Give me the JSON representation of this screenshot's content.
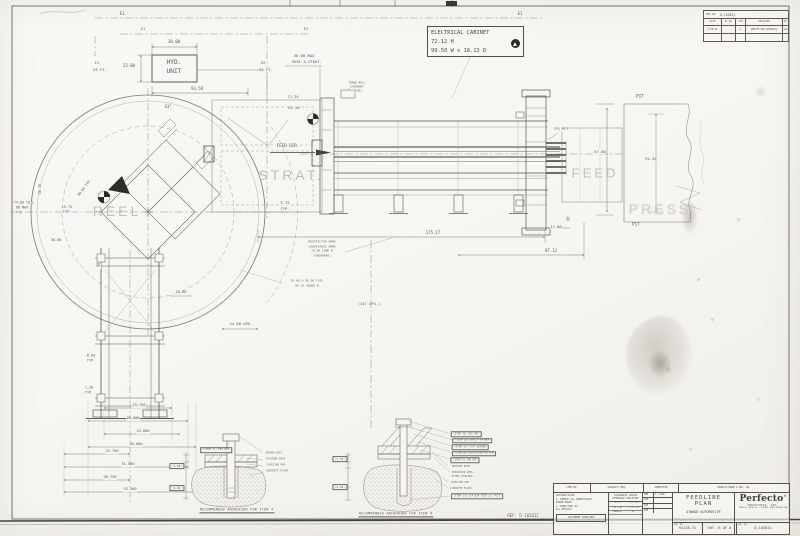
{
  "colors": {
    "line": "#5d5a53",
    "paper": "#f7f6f2",
    "ghost_text": "#bfbdb6"
  },
  "electrical_cabinet": {
    "line1": "ELECTRICAL CABINET",
    "line2": "72.12 H",
    "line3": "99.50 W x 18.13 D"
  },
  "revision_block": {
    "dwg_label": "DWG NO.",
    "dwg_no": "D-103021",
    "headers": [
      "DATE",
      "EC NO",
      "SYM",
      "REVISION",
      "BY"
    ],
    "rows": [
      [
        "2-28-92",
        "",
        "A",
        "UPDATE PER APPROVAL",
        "JAS"
      ]
    ]
  },
  "title_block": {
    "parts_header": [
      "ITEM NO.",
      "QUANTITY REQ.",
      "SUBMITTED",
      "MANUFACTURER & MDL. NO."
    ],
    "notes_title": "MACHINE NOTES",
    "notes": [
      "1. REMOVE ALL UNNECESSARY",
      "   SHARP EDGES",
      "2. MARK PART NO.",
      "   ALL DETAILS"
    ],
    "customer_supplied": "CUSTOMER SUPPLIED",
    "tol_title1": "TOLERANCES UNLESS",
    "tol_title2": "OTHERWISE SPECIFIED",
    "tol_rows": [
      [
        ".X ±.1",
        "1 PL ±.5"
      ],
      [
        ".XX ±.01",
        "2 PL ±.13"
      ],
      [
        "ANGLES",
        "±1°"
      ]
    ],
    "appr_rows": [
      [
        "DRN",
        "P. LACE"
      ],
      [
        "CHK",
        ""
      ],
      [
        "APP",
        ""
      ],
      [
        "APP",
        ""
      ]
    ],
    "title_line1": "FEEDLINE",
    "title_line2": "PLAN",
    "customer": "ATWOOD AUTOMOTIVE",
    "ord_label": "ORD. NO.",
    "ord_no": "92128-31",
    "sheet": "SHT. 8 OF 8",
    "dwg_label": "DWG. NO.",
    "dwg_no": "D-103021",
    "brand": "Perfecto",
    "brand_reg": "®",
    "brand_line2": "INDUSTRIES, INC.",
    "brand_line3": "1999 W. HIGH ST., PIQUA, OHIO 45356 USA"
  },
  "annotations": [
    {
      "t": "REEL",
      "x": 117,
      "y": 211,
      "s": 14,
      "c": "ghost"
    },
    {
      "t": "STRAT.",
      "x": 291,
      "y": 175,
      "s": 14,
      "c": "ghost"
    },
    {
      "t": "FEED",
      "x": 595,
      "y": 173,
      "s": 13,
      "c": "ghost"
    },
    {
      "t": "PRESS",
      "x": 660,
      "y": 209,
      "s": 14,
      "c": "ghostb"
    },
    {
      "t": "E1",
      "x": 122,
      "y": 14,
      "s": 4
    },
    {
      "t": "E1",
      "x": 520,
      "y": 14,
      "s": 4
    },
    {
      "t": "E1",
      "x": 143,
      "y": 30,
      "s": 3.6
    },
    {
      "t": "E1",
      "x": 306,
      "y": 30,
      "s": 3.6
    },
    {
      "t": "E1",
      "x": 97,
      "y": 63,
      "s": 3.8
    },
    {
      "t": "55 FT.",
      "x": 100,
      "y": 70,
      "s": 3.8
    },
    {
      "t": "E2",
      "x": 263,
      "y": 63,
      "s": 3.8
    },
    {
      "t": "55 FT.",
      "x": 266,
      "y": 70,
      "s": 3.8
    },
    {
      "t": "38.00",
      "x": 174,
      "y": 42,
      "s": 4
    },
    {
      "t": "22.00",
      "x": 129,
      "y": 66,
      "s": 4
    },
    {
      "t": "HYD.",
      "x": 174,
      "y": 63,
      "s": 6.2
    },
    {
      "t": "UNIT",
      "x": 174,
      "y": 72,
      "s": 6.2
    },
    {
      "t": "93.50",
      "x": 197,
      "y": 89,
      "s": 4
    },
    {
      "t": "43°",
      "x": 168,
      "y": 107,
      "s": 4
    },
    {
      "t": "72.24",
      "x": 293,
      "y": 97,
      "s": 3.8
    },
    {
      "t": "65.26",
      "x": 294,
      "y": 108,
      "s": 3.8
    },
    {
      "t": "36.00 MAX",
      "x": 304,
      "y": 56,
      "s": 3.8
    },
    {
      "t": "REEL & STRAT.",
      "x": 307,
      "y": 62,
      "s": 3.8
    },
    {
      "t": "THREE ROLL",
      "x": 357,
      "y": 83,
      "s": 2.8,
      "c": "tiny"
    },
    {
      "t": "CATENARY",
      "x": 357,
      "y": 87,
      "s": 2.8,
      "c": "tiny"
    },
    {
      "t": "(STEEL)",
      "x": 357,
      "y": 91,
      "s": 2.8,
      "c": "tiny"
    },
    {
      "t": "FEED DIR.",
      "x": 288,
      "y": 146,
      "s": 4.2
    },
    {
      "t": "5.75",
      "x": 285,
      "y": 203,
      "s": 3.8
    },
    {
      "t": "TYP.",
      "x": 285,
      "y": 209,
      "s": 3.8
    },
    {
      "t": "74.00 COIL",
      "x": 24,
      "y": 203,
      "s": 3.4
    },
    {
      "t": "OD MAX",
      "x": 22,
      "y": 208,
      "s": 3.4
    },
    {
      "t": "TYP.",
      "x": 20,
      "y": 213,
      "s": 3.4
    },
    {
      "t": "36.50",
      "x": 41,
      "y": 189,
      "s": 3.6,
      "r": -90
    },
    {
      "t": "15.75",
      "x": 67,
      "y": 208,
      "s": 3.6
    },
    {
      "t": "TYP.",
      "x": 67,
      "y": 213,
      "s": 3.6
    },
    {
      "t": "30.00",
      "x": 56,
      "y": 241,
      "s": 3.6
    },
    {
      "t": "50.04 TYP.",
      "x": 85,
      "y": 188,
      "s": 3.4,
      "r": -52
    },
    {
      "t": "8.03",
      "x": 91,
      "y": 356,
      "s": 3.4
    },
    {
      "t": "TYP.",
      "x": 91,
      "y": 361,
      "s": 3.4
    },
    {
      "t": "1.20",
      "x": 89,
      "y": 388,
      "s": 3.4
    },
    {
      "t": "TYP.",
      "x": 89,
      "y": 393,
      "s": 3.4
    },
    {
      "t": "175.17",
      "x": 433,
      "y": 233,
      "s": 4
    },
    {
      "t": "87.12",
      "x": 551,
      "y": 251,
      "s": 4
    },
    {
      "t": "17.00",
      "x": 556,
      "y": 227,
      "s": 3.8
    },
    {
      "t": "①",
      "x": 568,
      "y": 220,
      "s": 5.5
    },
    {
      "t": "②",
      "x": 98,
      "y": 266,
      "s": 5.5
    },
    {
      "t": "RESTRICTOR ARMS",
      "x": 322,
      "y": 242,
      "s": 3,
      "c": "tiny"
    },
    {
      "t": "CONVEYANCE ARMS",
      "x": 322,
      "y": 246.5,
      "s": 3,
      "c": "tiny"
    },
    {
      "t": "70.00 LONG R",
      "x": 322,
      "y": 251,
      "s": 3,
      "c": "tiny"
    },
    {
      "t": "(OVERHEAD)",
      "x": 322,
      "y": 255.5,
      "s": 3,
      "c": "tiny"
    },
    {
      "t": "70.00 & 36.50 COIL",
      "x": 307,
      "y": 281,
      "s": 3,
      "c": "tiny"
    },
    {
      "t": "80.25 SWING R",
      "x": 307,
      "y": 285.5,
      "s": 3,
      "c": "tiny"
    },
    {
      "t": "(147 APX.)",
      "x": 369,
      "y": 304,
      "s": 3.8
    },
    {
      "t": "24.00 APX.",
      "x": 241,
      "y": 324,
      "s": 3.8
    },
    {
      "t": "18.00",
      "x": 181,
      "y": 293,
      "s": 3.6
    },
    {
      "t": "CPLG NO.2",
      "x": 561,
      "y": 130,
      "s": 2.6,
      "c": "tiny"
    },
    {
      "t": "67.00",
      "x": 600,
      "y": 152,
      "s": 3.8
    },
    {
      "t": "PIT",
      "x": 640,
      "y": 98,
      "s": 4.6
    },
    {
      "t": "92.38",
      "x": 651,
      "y": 159,
      "s": 3.8
    },
    {
      "t": "PIT",
      "x": 636,
      "y": 226,
      "s": 4.6
    },
    {
      "t": "19.750",
      "x": 139,
      "y": 406,
      "s": 3.6
    },
    {
      "t": "39.500",
      "x": 133,
      "y": 419,
      "s": 3.6
    },
    {
      "t": "23.000",
      "x": 143,
      "y": 432,
      "s": 3.6
    },
    {
      "t": "46.000",
      "x": 136,
      "y": 445,
      "s": 3.6
    },
    {
      "t": "25.750",
      "x": 112,
      "y": 452,
      "s": 3.6
    },
    {
      "t": "51.500",
      "x": 128,
      "y": 465,
      "s": 3.6
    },
    {
      "t": "26.750",
      "x": 110,
      "y": 478,
      "s": 3.6
    },
    {
      "t": "53.500",
      "x": 130,
      "y": 490,
      "s": 3.6
    },
    {
      "t": "(ITEM 17) HEX NUT",
      "x": 216,
      "y": 450,
      "s": 2.6,
      "c": "box"
    },
    {
      "t": "ANCHOR BOLT",
      "x": 274,
      "y": 454,
      "s": 2.6,
      "c": "tiny"
    },
    {
      "t": "MACHINE BASE",
      "x": 276,
      "y": 460,
      "s": 2.6,
      "c": "tiny"
    },
    {
      "t": "LEVELING PAD",
      "x": 276,
      "y": 466,
      "s": 2.6,
      "c": "tiny"
    },
    {
      "t": "CONCRETE FLOOR",
      "x": 277,
      "y": 472,
      "s": 2.6,
      "c": "tiny"
    },
    {
      "t": "(4.00)",
      "x": 177,
      "y": 466,
      "s": 2.8,
      "c": "box"
    },
    {
      "t": "(6.00)",
      "x": 177,
      "y": 488,
      "s": 2.8,
      "c": "box"
    },
    {
      "t": "RECOMMENDED ANCHORING FOR ITEM ①",
      "x": 237,
      "y": 511,
      "s": 3.3,
      "c": "caption"
    },
    {
      "t": "(ITEM 16) HEX NUT",
      "x": 466,
      "y": 434,
      "s": 2.5,
      "c": "box"
    },
    {
      "t": "(ITEM 15) SAFETY WASHER",
      "x": 472,
      "y": 440.5,
      "s": 2.5,
      "c": "box"
    },
    {
      "t": "(ITEM 14) FLAT WASHER",
      "x": 470,
      "y": 447,
      "s": 2.5,
      "c": "box"
    },
    {
      "t": "(ITEM 8) 5/8-11 UNC HD SCR",
      "x": 474,
      "y": 453.5,
      "s": 2.5,
      "c": "box"
    },
    {
      "t": "(ITEM 9) JAM NUT",
      "x": 465,
      "y": 460,
      "s": 2.5,
      "c": "box"
    },
    {
      "t": "MACHINE BASE",
      "x": 461,
      "y": 466.5,
      "s": 2.5,
      "c": "tiny"
    },
    {
      "t": "EXPANSION SHELL",
      "x": 463,
      "y": 472.5,
      "s": 2.5,
      "c": "tiny"
    },
    {
      "t": "AFTER LEVELING",
      "x": 462,
      "y": 476.5,
      "s": 2.5,
      "c": "tiny"
    },
    {
      "t": "LEVELING PAD",
      "x": 460,
      "y": 482.5,
      "s": 2.5,
      "c": "tiny"
    },
    {
      "t": "CONCRETE FLOOR",
      "x": 461,
      "y": 488.5,
      "s": 2.5,
      "c": "tiny"
    },
    {
      "t": "(ITEM 13) 3/4 DIA STUD (2) PLCS",
      "x": 477,
      "y": 496,
      "s": 2.5,
      "c": "box"
    },
    {
      "t": "(1.50)",
      "x": 340,
      "y": 459,
      "s": 2.8,
      "c": "box"
    },
    {
      "t": "(8.00)",
      "x": 340,
      "y": 487,
      "s": 2.8,
      "c": "box"
    },
    {
      "t": "RECOMMENDED ANCHORING FOR ITEM ②",
      "x": 396,
      "y": 515,
      "s": 3.3,
      "c": "caption"
    },
    {
      "t": "REF: D-102812",
      "x": 523,
      "y": 516,
      "s": 4
    }
  ]
}
